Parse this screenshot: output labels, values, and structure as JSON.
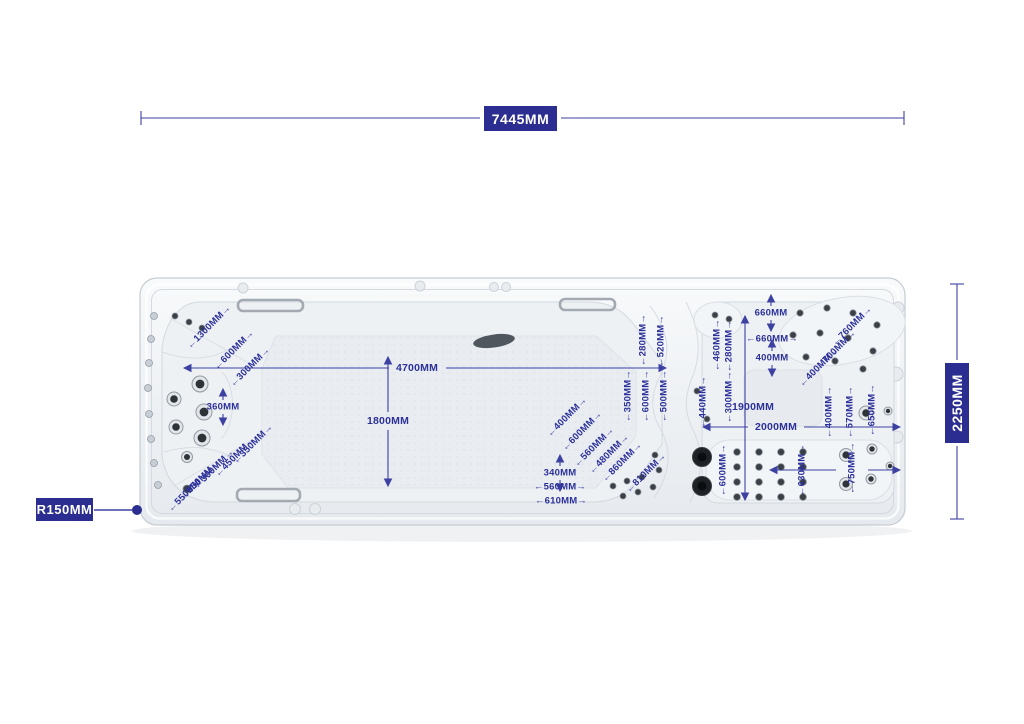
{
  "colors": {
    "dimension_blue": "#2b2e90",
    "dimension_line": "#3c41a2",
    "annotation_text": "#2c309a",
    "shell_fill": "#eef1f4",
    "shell_stroke": "#c6ccd3"
  },
  "main_dimensions": {
    "overall_length": "7445MM",
    "overall_width": "2250MM",
    "corner_radius": "R150MM"
  },
  "annotations": [
    {
      "text": "1300MM",
      "x": 209,
      "y": 327,
      "rotate": -45,
      "arrow": "inline"
    },
    {
      "text": "600MM",
      "x": 234,
      "y": 350,
      "rotate": -45,
      "arrow": "inline"
    },
    {
      "text": "300MM",
      "x": 250,
      "y": 367,
      "rotate": -45,
      "arrow": "inline"
    },
    {
      "text": "360MM",
      "x": 223,
      "y": 407,
      "rotate": 0,
      "arrow": "updown"
    },
    {
      "text": "350MM",
      "x": 253,
      "y": 444,
      "rotate": -45,
      "arrow": "inline"
    },
    {
      "text": "450MM",
      "x": 235,
      "y": 457,
      "rotate": -45,
      "arrow": "inline"
    },
    {
      "text": "300MM",
      "x": 214,
      "y": 469,
      "rotate": -45,
      "arrow": "inline"
    },
    {
      "text": "650MM",
      "x": 200,
      "y": 480,
      "rotate": -45,
      "arrow": "inline"
    },
    {
      "text": "550MM",
      "x": 188,
      "y": 492,
      "rotate": -45,
      "arrow": "inline"
    },
    {
      "text": "4700MM",
      "x": 417,
      "y": 368,
      "rotate": 0,
      "arrow": "none"
    },
    {
      "text": "1800MM",
      "x": 388,
      "y": 421,
      "rotate": 0,
      "arrow": "none"
    },
    {
      "text": "400MM",
      "x": 567,
      "y": 417,
      "rotate": -45,
      "arrow": "inline"
    },
    {
      "text": "600MM",
      "x": 582,
      "y": 431,
      "rotate": -45,
      "arrow": "inline"
    },
    {
      "text": "560MM",
      "x": 594,
      "y": 447,
      "rotate": -45,
      "arrow": "inline"
    },
    {
      "text": "480MM",
      "x": 609,
      "y": 454,
      "rotate": -45,
      "arrow": "inline"
    },
    {
      "text": "860MM",
      "x": 622,
      "y": 462,
      "rotate": -45,
      "arrow": "inline"
    },
    {
      "text": "810MM",
      "x": 646,
      "y": 473,
      "rotate": -45,
      "arrow": "inline"
    },
    {
      "text": "340MM",
      "x": 560,
      "y": 473,
      "rotate": 0,
      "arrow": "updown"
    },
    {
      "text": "560MM",
      "x": 560,
      "y": 487,
      "rotate": 0,
      "arrow": "inline"
    },
    {
      "text": "610MM",
      "x": 561,
      "y": 501,
      "rotate": 0,
      "arrow": "inline"
    },
    {
      "text": "280MM",
      "x": 643,
      "y": 340,
      "rotate": -90,
      "arrow": "inline"
    },
    {
      "text": "520MM",
      "x": 661,
      "y": 341,
      "rotate": -90,
      "arrow": "inline"
    },
    {
      "text": "350MM",
      "x": 628,
      "y": 396,
      "rotate": -90,
      "arrow": "inline"
    },
    {
      "text": "600MM",
      "x": 646,
      "y": 396,
      "rotate": -90,
      "arrow": "inline"
    },
    {
      "text": "500MM",
      "x": 664,
      "y": 396,
      "rotate": -90,
      "arrow": "inline"
    },
    {
      "text": "460MM",
      "x": 717,
      "y": 345,
      "rotate": -90,
      "arrow": "inline"
    },
    {
      "text": "280MM",
      "x": 729,
      "y": 346,
      "rotate": -90,
      "arrow": "inline"
    },
    {
      "text": "660MM",
      "x": 771,
      "y": 313,
      "rotate": 0,
      "arrow": "updown"
    },
    {
      "text": "660MM",
      "x": 772,
      "y": 339,
      "rotate": 0,
      "arrow": "inline"
    },
    {
      "text": "400MM",
      "x": 772,
      "y": 358,
      "rotate": 0,
      "arrow": "updown"
    },
    {
      "text": "440MM",
      "x": 703,
      "y": 402,
      "rotate": -90,
      "arrow": "inline"
    },
    {
      "text": "300MM",
      "x": 729,
      "y": 397,
      "rotate": -90,
      "arrow": "inline"
    },
    {
      "text": "1900MM",
      "x": 753,
      "y": 407,
      "rotate": 0,
      "arrow": "none"
    },
    {
      "text": "2000MM",
      "x": 776,
      "y": 427,
      "rotate": 0,
      "arrow": "none"
    },
    {
      "text": "760MM",
      "x": 852,
      "y": 326,
      "rotate": -45,
      "arrow": "inline"
    },
    {
      "text": "700MM",
      "x": 836,
      "y": 350,
      "rotate": -45,
      "arrow": "inline"
    },
    {
      "text": "400MM",
      "x": 819,
      "y": 367,
      "rotate": -45,
      "arrow": "inline"
    },
    {
      "text": "400MM",
      "x": 829,
      "y": 412,
      "rotate": -90,
      "arrow": "inline"
    },
    {
      "text": "570MM",
      "x": 850,
      "y": 412,
      "rotate": -90,
      "arrow": "inline"
    },
    {
      "text": "650MM",
      "x": 872,
      "y": 410,
      "rotate": -90,
      "arrow": "inline"
    },
    {
      "text": "600MM",
      "x": 723,
      "y": 470,
      "rotate": -90,
      "arrow": "inline"
    },
    {
      "text": "630MM",
      "x": 802,
      "y": 470,
      "rotate": -90,
      "arrow": "inline"
    },
    {
      "text": "750MM",
      "x": 852,
      "y": 468,
      "rotate": -90,
      "arrow": "inline"
    }
  ]
}
